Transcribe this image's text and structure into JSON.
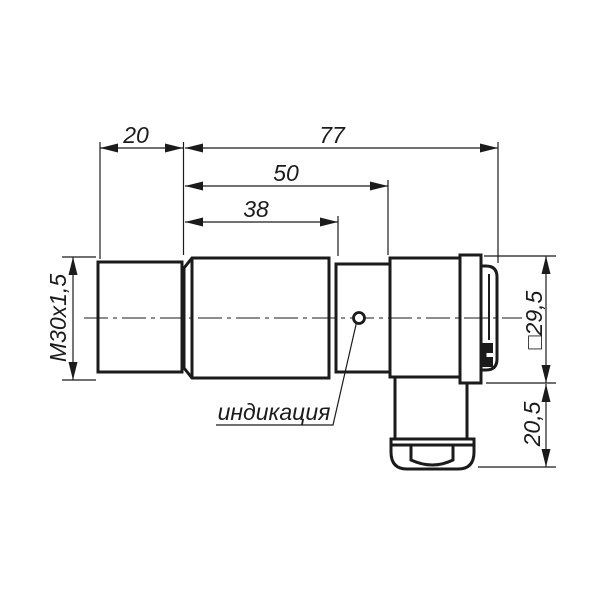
{
  "drawing": {
    "background_color": "#ffffff",
    "line_color": "#1b1b1b",
    "dimensions": {
      "thread_length": "20",
      "overall_length": "77",
      "housing_length": "50",
      "barrel_length": "38",
      "thread_designation": "M30x1,5",
      "connector_body_size": "□29,5",
      "connector_drop_height": "20,5"
    },
    "labels": {
      "indicator": "индикация"
    }
  }
}
